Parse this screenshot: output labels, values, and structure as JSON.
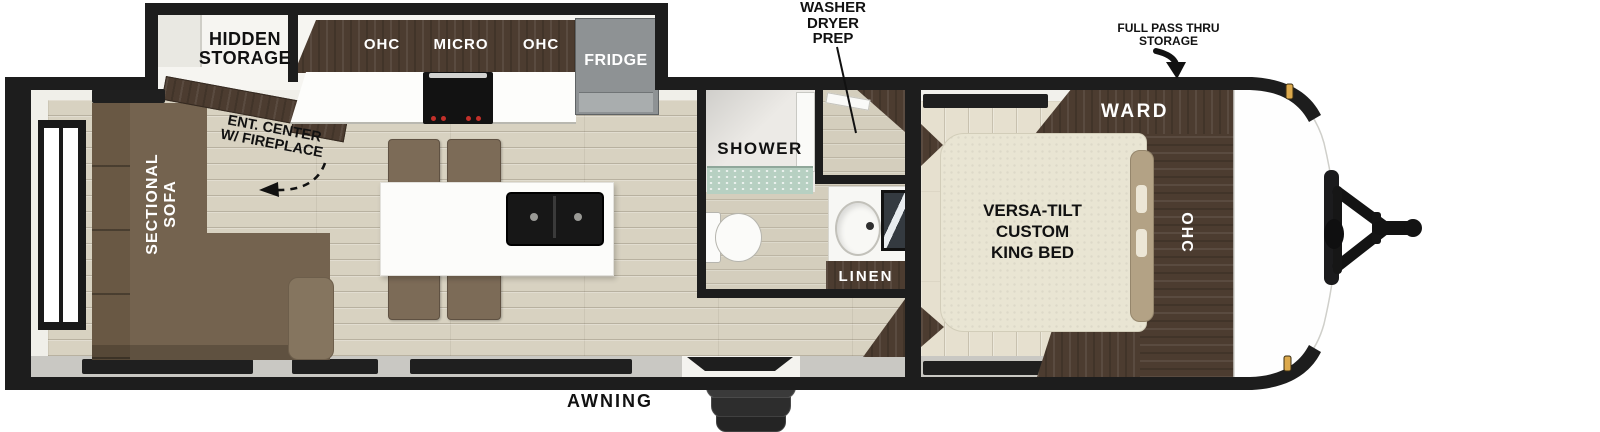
{
  "labels": {
    "living": {
      "hidden_storage": [
        "HIDDEN",
        "STORAGE"
      ],
      "ent_center": [
        "ENT. CENTER",
        "W/ FIREPLACE"
      ],
      "sectional_sofa": [
        "SECTIONAL",
        "SOFA"
      ]
    },
    "kitchen": {
      "ohc_left": "OHC",
      "micro": "MICRO",
      "ohc_right": "OHC",
      "fridge": "FRIDGE"
    },
    "bathroom": {
      "shower": "SHOWER",
      "linen": "LINEN"
    },
    "bedroom": {
      "ward": "WARD",
      "ohc": "OHC",
      "bed": [
        "VERSA-TILT",
        "CUSTOM",
        "KING BED"
      ]
    },
    "exterior": {
      "washer_dryer_prep": [
        "WASHER",
        "DRYER",
        "PREP"
      ],
      "full_pass_thru": [
        "FULL PASS THRU",
        "STORAGE"
      ],
      "awning": "AWNING"
    }
  },
  "colors": {
    "wall": "#1d1d1d",
    "cabinet_wood": "#4c3c30",
    "sofa_brown": "#74634f",
    "floor_beige": "#d8d2c1",
    "bedroom_floor_cream": "#e6e0cf",
    "bed_cream": "#e9e5d3",
    "fridge_gray": "#8e9294",
    "clearance_light_amber": "#dca94c",
    "shower_tile_green": "#b7d0c2"
  }
}
